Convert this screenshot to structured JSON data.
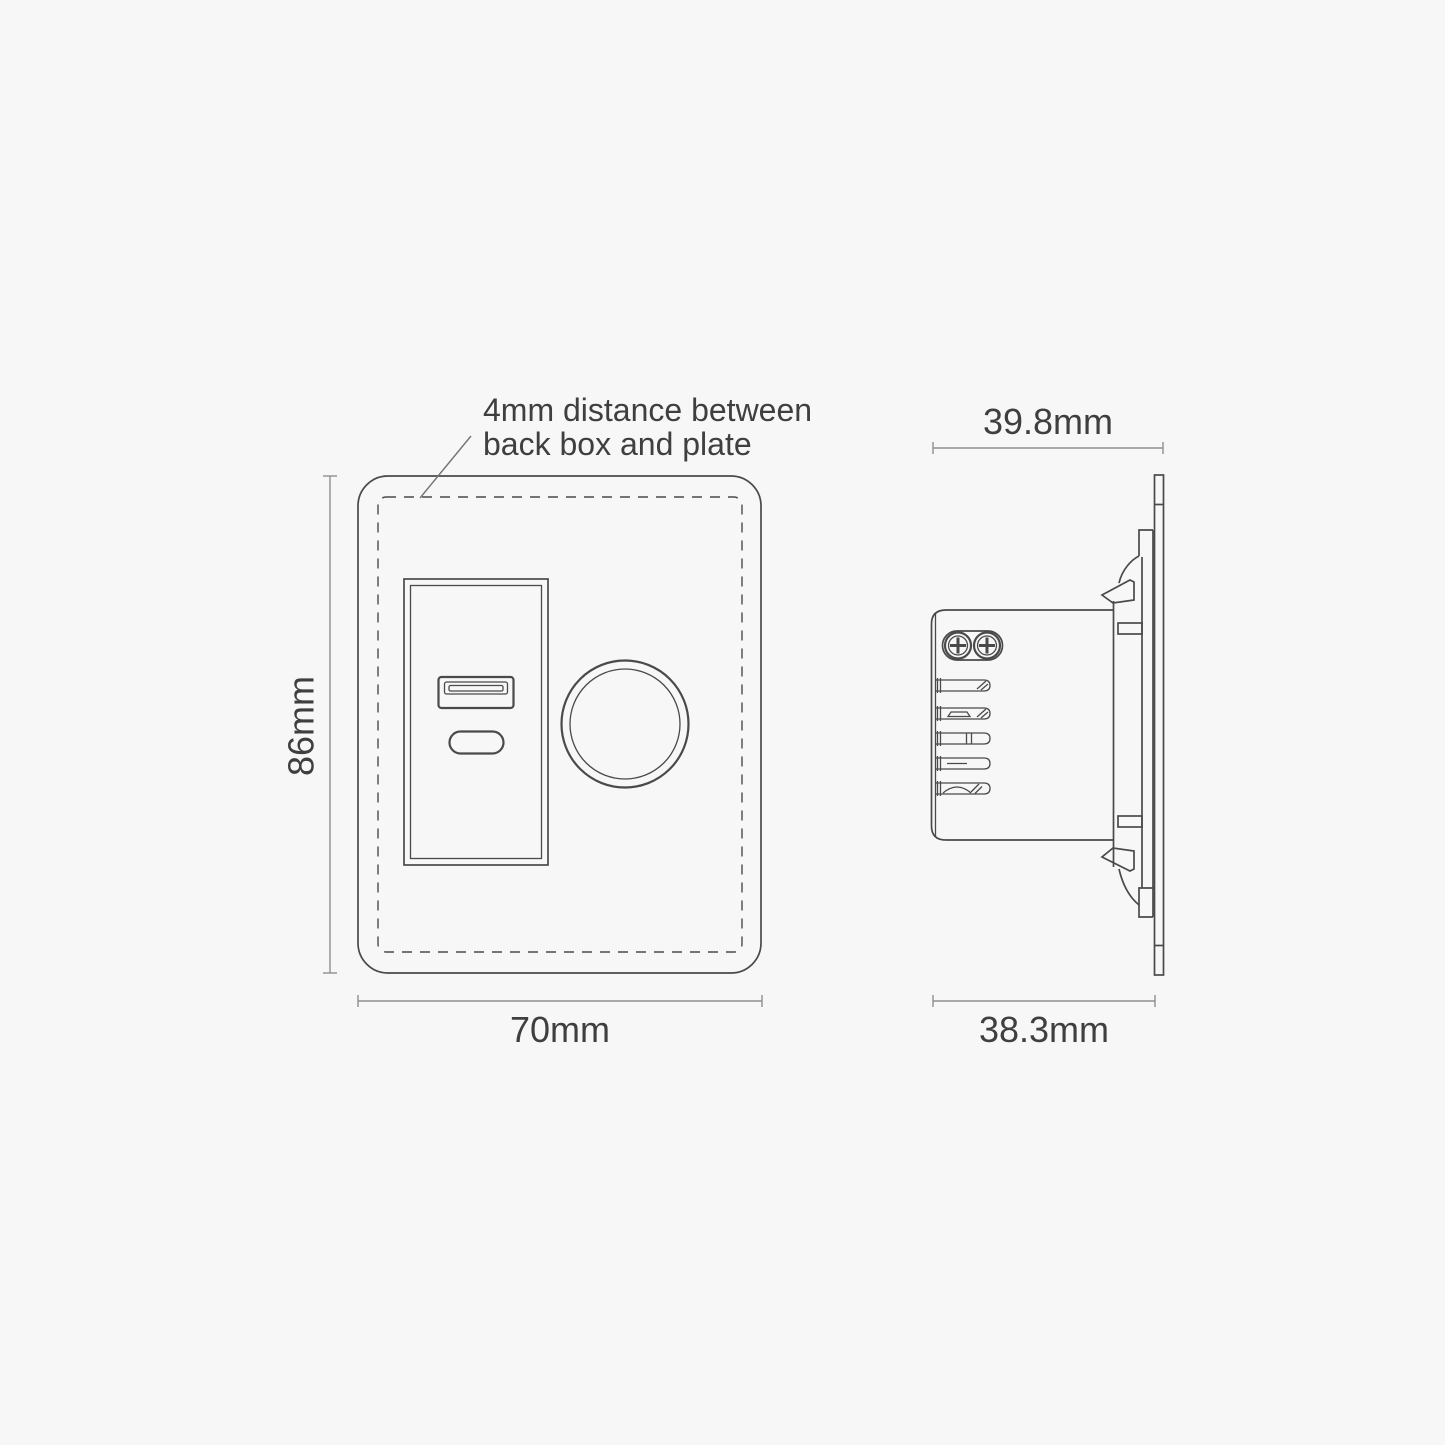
{
  "colors": {
    "background": "#f7f7f7",
    "line": "#4a4a4a",
    "dim": "#8f8f8f",
    "leader": "#757575",
    "text": "#3f3f3f"
  },
  "annotation": {
    "line1": "4mm distance between",
    "line2": "back box and plate"
  },
  "front_view": {
    "height_label": "86mm",
    "width_label": "70mm"
  },
  "side_view": {
    "top_width_label": "39.8mm",
    "bottom_width_label": "38.3mm"
  }
}
